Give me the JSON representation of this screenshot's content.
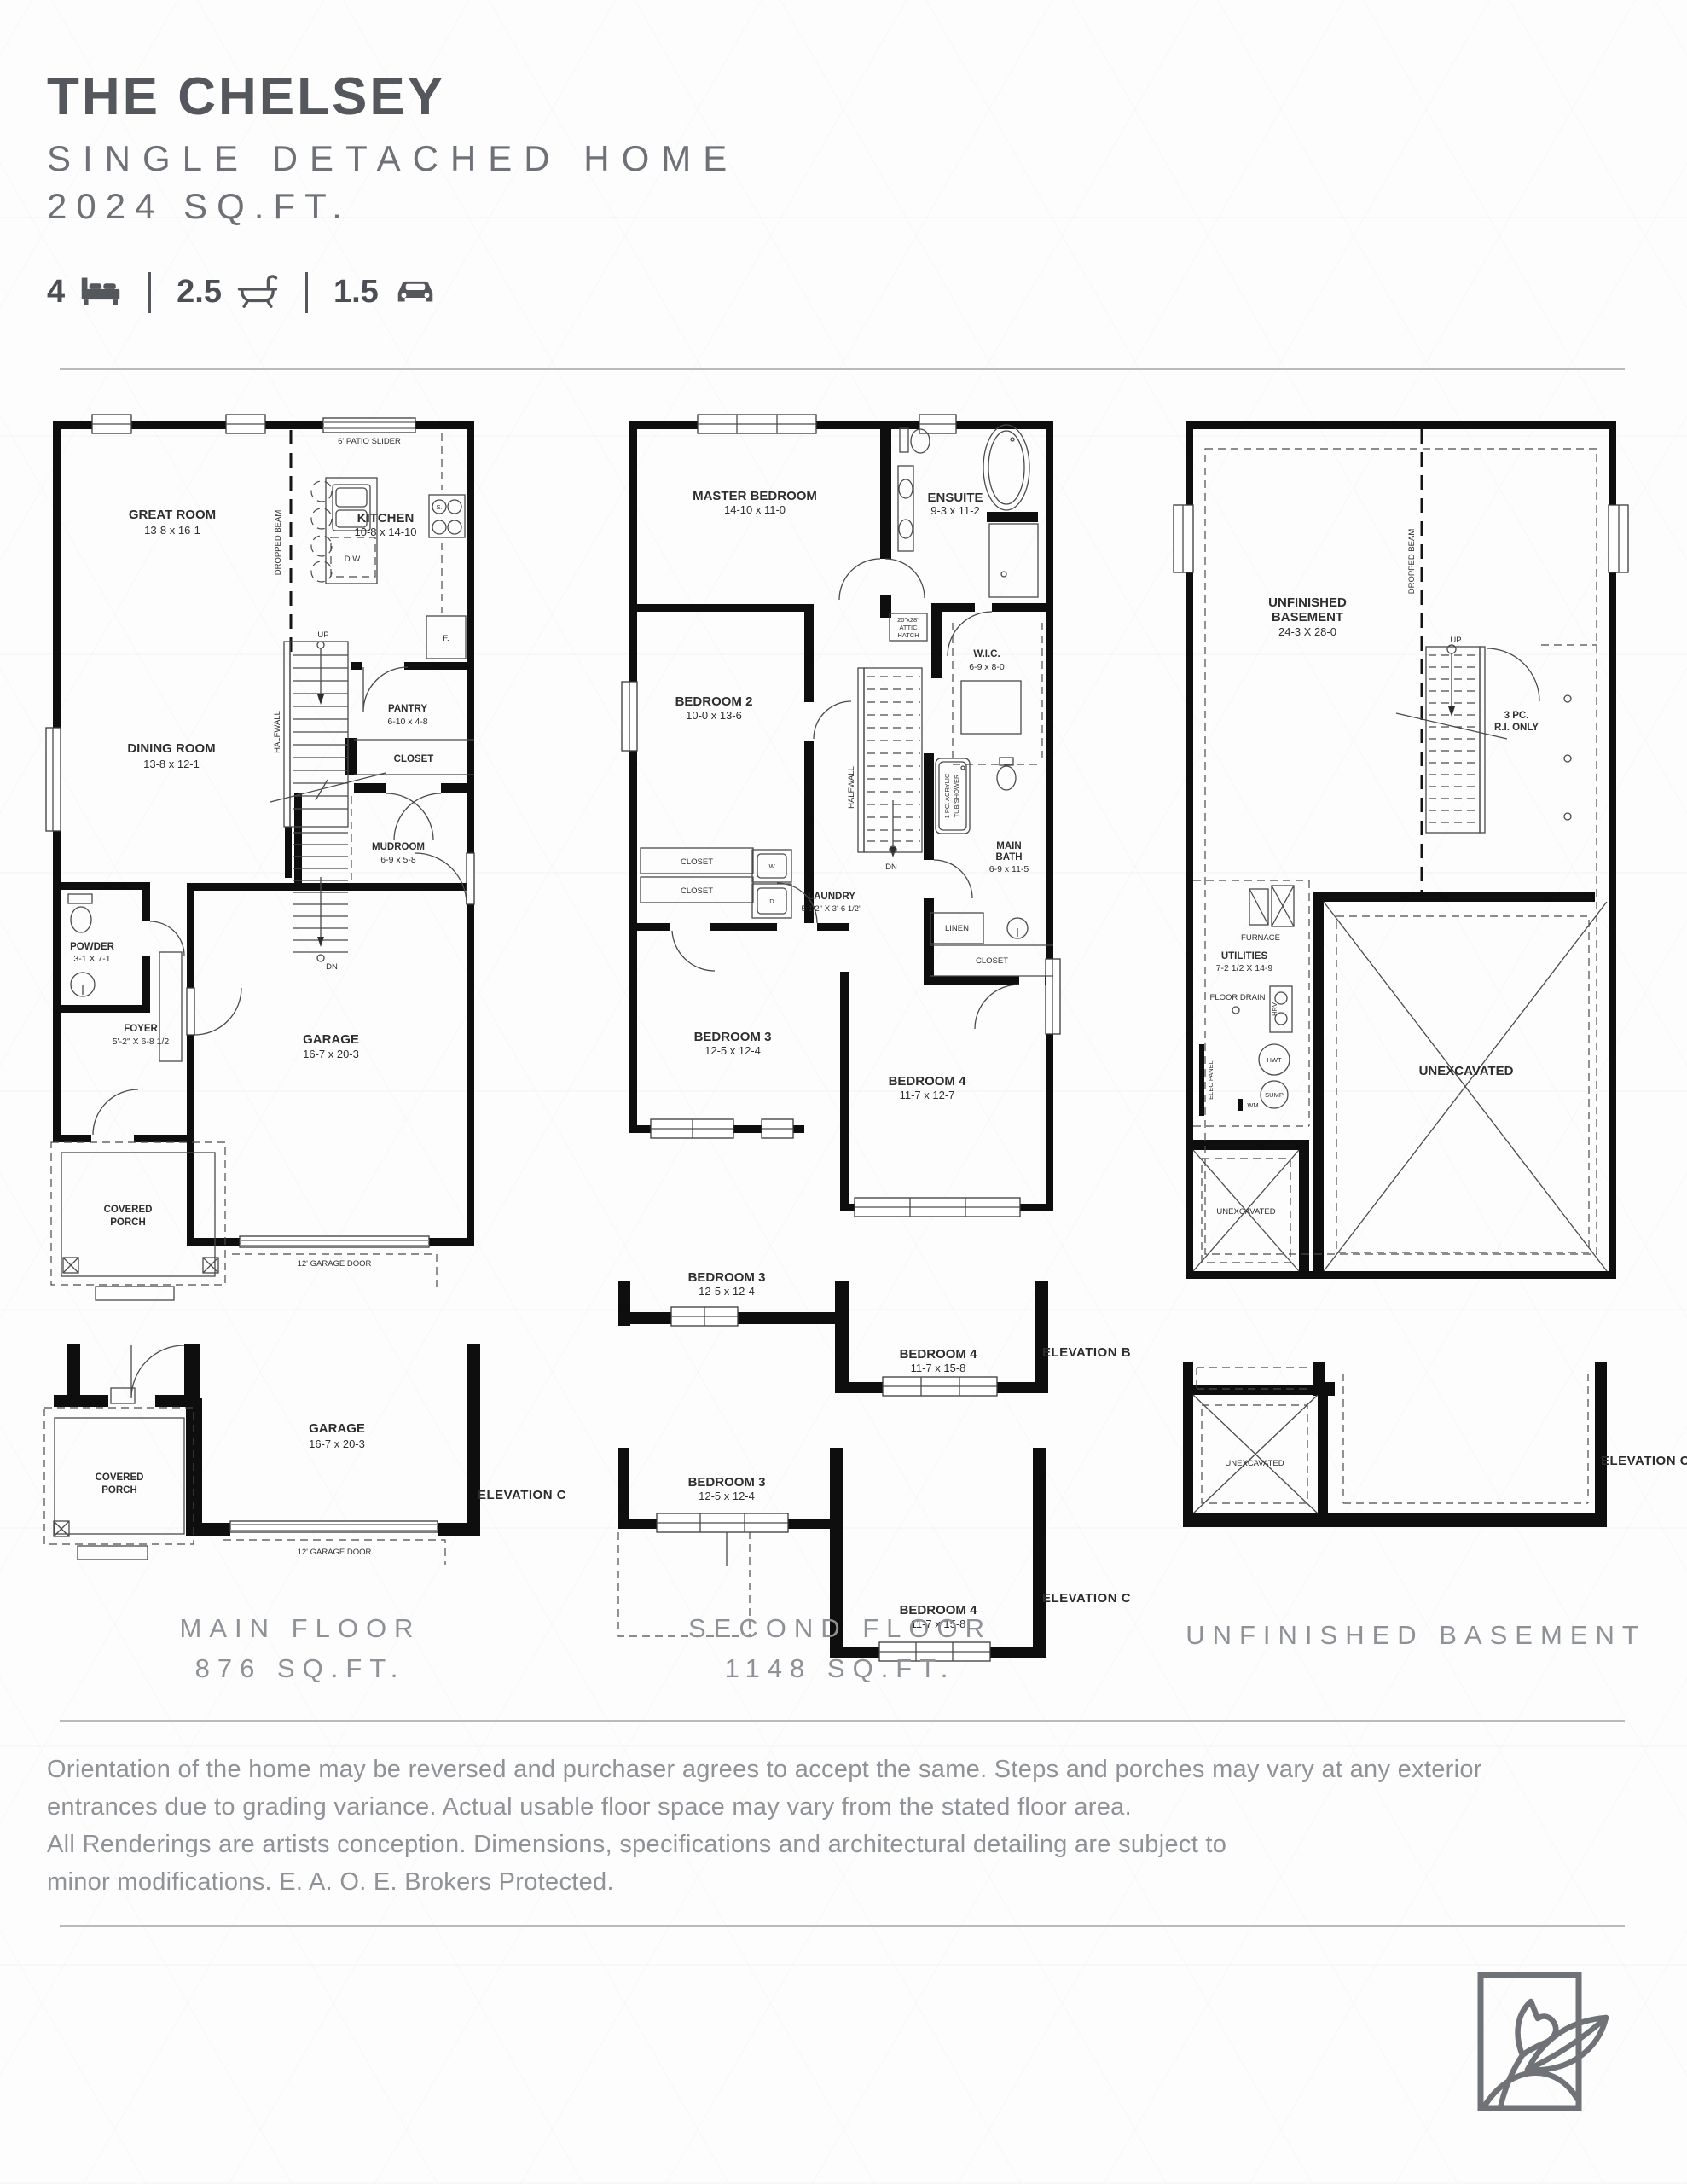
{
  "header": {
    "title": "THE CHELSEY",
    "subtitle": "SINGLE DETACHED HOME",
    "area": "2024 SQ.FT.",
    "stats": {
      "beds": "4",
      "beds_icon": "bed-icon",
      "baths": "2.5",
      "baths_icon": "bathtub-icon",
      "cars": "1.5",
      "cars_icon": "car-icon"
    }
  },
  "colors": {
    "wall": "#0e0e0e",
    "heading_dark": "#54575c",
    "text_gray": "#8f9296",
    "divider": "#b9babc"
  },
  "plans": {
    "main": {
      "caption": "MAIN FLOOR",
      "area": "876 SQ.FT.",
      "patio": "6' PATIO SLIDER",
      "dropped_beam": "DROPPED BEAM",
      "halfwall": "HALFWALL",
      "up": "UP",
      "dn": "DN",
      "great_name": "GREAT ROOM",
      "great_dims": "13-8 x 16-1",
      "kitchen_name": "KITCHEN",
      "kitchen_dims": "10-8 x 14-10",
      "dw": "D.W.",
      "stove_s": "S.",
      "fridge": "F.",
      "dining_name": "DINING ROOM",
      "dining_dims": "13-8 x 12-1",
      "pantry_name": "PANTRY",
      "pantry_dims": "6-10 x 4-8",
      "closet": "CLOSET",
      "mud_name": "MUDROOM",
      "mud_dims": "6-9 x 5-8",
      "powder_name": "POWDER",
      "powder_dims": "3-1 X 7-1",
      "foyer_name": "FOYER",
      "foyer_dims": "5'-2\" X 6-8 1/2",
      "garage_name": "GARAGE",
      "garage_dims": "16-7 x 20-3",
      "covered": "COVERED",
      "porch": "PORCH",
      "garage_door": "12' GARAGE DOOR"
    },
    "second": {
      "caption": "SECOND FLOOR",
      "area": "1148 SQ.FT.",
      "master_name": "MASTER BEDROOM",
      "master_dims": "14-10 x 11-0",
      "ensuite_name": "ENSUITE",
      "ensuite_dims": "9-3 x 11-2",
      "bed2_name": "BEDROOM 2",
      "bed2_dims": "10-0 x 13-6",
      "attic_l1": "20\"x28\"",
      "attic_l2": "ATTIC",
      "attic_l3": "HATCH",
      "wic_name": "W.I.C.",
      "wic_dims": "6-9 x 8-0",
      "halfwall": "HALFWALL",
      "dn": "DN",
      "tub_l1": "1 PC. ACRYLIC",
      "tub_l2": "TUB/SHOWER",
      "bath_l1": "MAIN",
      "bath_l2": "BATH",
      "bath_dims": "6-9 x 11-5",
      "closet": "CLOSET",
      "linen": "LINEN",
      "washer": "W",
      "dryer": "D",
      "laundry_name": "LAUNDRY",
      "laundry_dims": "5 1/2\" X 3'-6 1/2\"",
      "bed3_name": "BEDROOM 3",
      "bed3_dims": "12-5 x 12-4",
      "bed4_name": "BEDROOM 4",
      "bed4_dims": "11-7 x 12-7"
    },
    "basement": {
      "caption": "UNFINISHED BASEMENT",
      "dropped_beam": "DROPPED BEAM",
      "name_l1": "UNFINISHED",
      "name_l2": "BASEMENT",
      "dims": "24-3 X 28-0",
      "up": "UP",
      "ri_l1": "3 PC.",
      "ri_l2": "R.I. ONLY",
      "furnace": "FURNACE",
      "utilities_name": "UTILITIES",
      "utilities_dims": "7-2 1/2 X 14-9",
      "floor_drain": "FLOOR DRAIN",
      "hrv": "HRV",
      "hwt": "HWT",
      "sump": "SUMP",
      "elec": "ELEC PANEL",
      "wm": "WM",
      "unex": "UNEXCAVATED"
    }
  },
  "variants": {
    "main_c": {
      "elevation": "ELEVATION C"
    },
    "second_b": {
      "elevation": "ELEVATION B",
      "bed4_dims": "11-7 x 15-8"
    },
    "second_c": {
      "elevation": "ELEVATION C",
      "bed4_dims": "11-7 x 15-8"
    },
    "basement_c": {
      "elevation": "ELEVATION C"
    }
  },
  "footer": {
    "line1": "Orientation of the home may be reversed and purchaser agrees to accept the same. Steps and porches may vary at any exterior",
    "line2": "entrances due to grading variance. Actual usable floor space may vary from the stated floor area.",
    "line3": "All Renderings are artists conception. Dimensions, specifications and architectural detailing are subject to",
    "line4": "minor modifications. E. A. O. E. Brokers Protected.",
    "logo_icon": "fox-leaf-logo"
  }
}
